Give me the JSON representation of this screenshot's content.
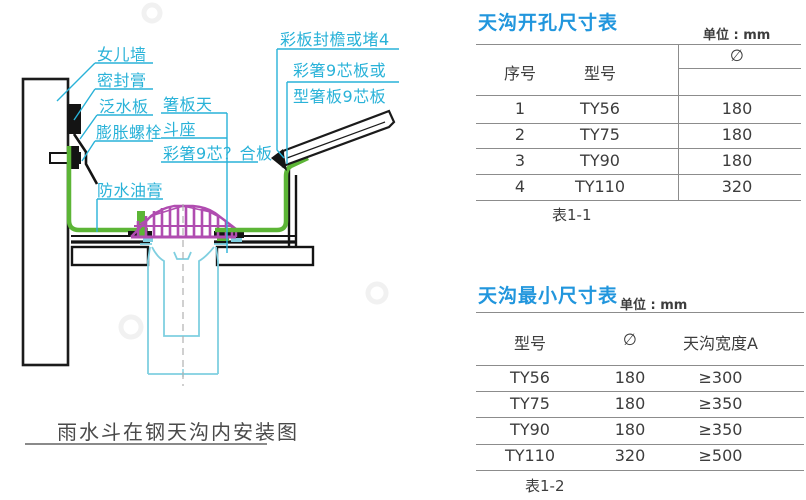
{
  "diagram": {
    "labels": {
      "parapet": "女儿墙",
      "sealant": "密封膏",
      "flashing": "泛水板",
      "expansion_bolt": "膨胀螺栓",
      "hopper_seat_line1": "箸板天",
      "hopper_seat_line2": "斗座",
      "composite_board": "彩箸9芯？合板",
      "waterproof_grease": "防水油膏",
      "eave_closure": "彩板封檐或堵4",
      "core_board_line1": "彩箸9芯板或",
      "core_board_line2": "型箸板9芯板"
    },
    "caption": "雨水斗在钢天沟内安装图",
    "colors": {
      "label_cyan": "#29b2d8",
      "strainer_magenta": "#b04cb0",
      "lining_green": "#5cb536",
      "pipe_cyan": "#7fcfe0",
      "line_black": "#141414"
    }
  },
  "table1": {
    "title": "天沟开孔尺寸表",
    "unit": "单位 : mm",
    "headers": {
      "no": "序号",
      "model": "型号",
      "diameter": "∅"
    },
    "rows": [
      {
        "no": "1",
        "model": "TY56",
        "diameter": "180"
      },
      {
        "no": "2",
        "model": "TY75",
        "diameter": "180"
      },
      {
        "no": "3",
        "model": "TY90",
        "diameter": "180"
      },
      {
        "no": "4",
        "model": "TY110",
        "diameter": "320"
      }
    ],
    "caption": "表1-1"
  },
  "table2": {
    "title": "天沟最小尺寸表",
    "unit": "单位 : mm",
    "headers": {
      "model": "型号",
      "diameter": "∅",
      "width": "天沟宽度A"
    },
    "rows": [
      {
        "model": "TY56",
        "diameter": "180",
        "width": "≥300"
      },
      {
        "model": "TY75",
        "diameter": "180",
        "width": "≥350"
      },
      {
        "model": "TY90",
        "diameter": "180",
        "width": "≥350"
      },
      {
        "model": "TY110",
        "diameter": "320",
        "width": "≥500"
      }
    ],
    "caption": "表1-2"
  }
}
